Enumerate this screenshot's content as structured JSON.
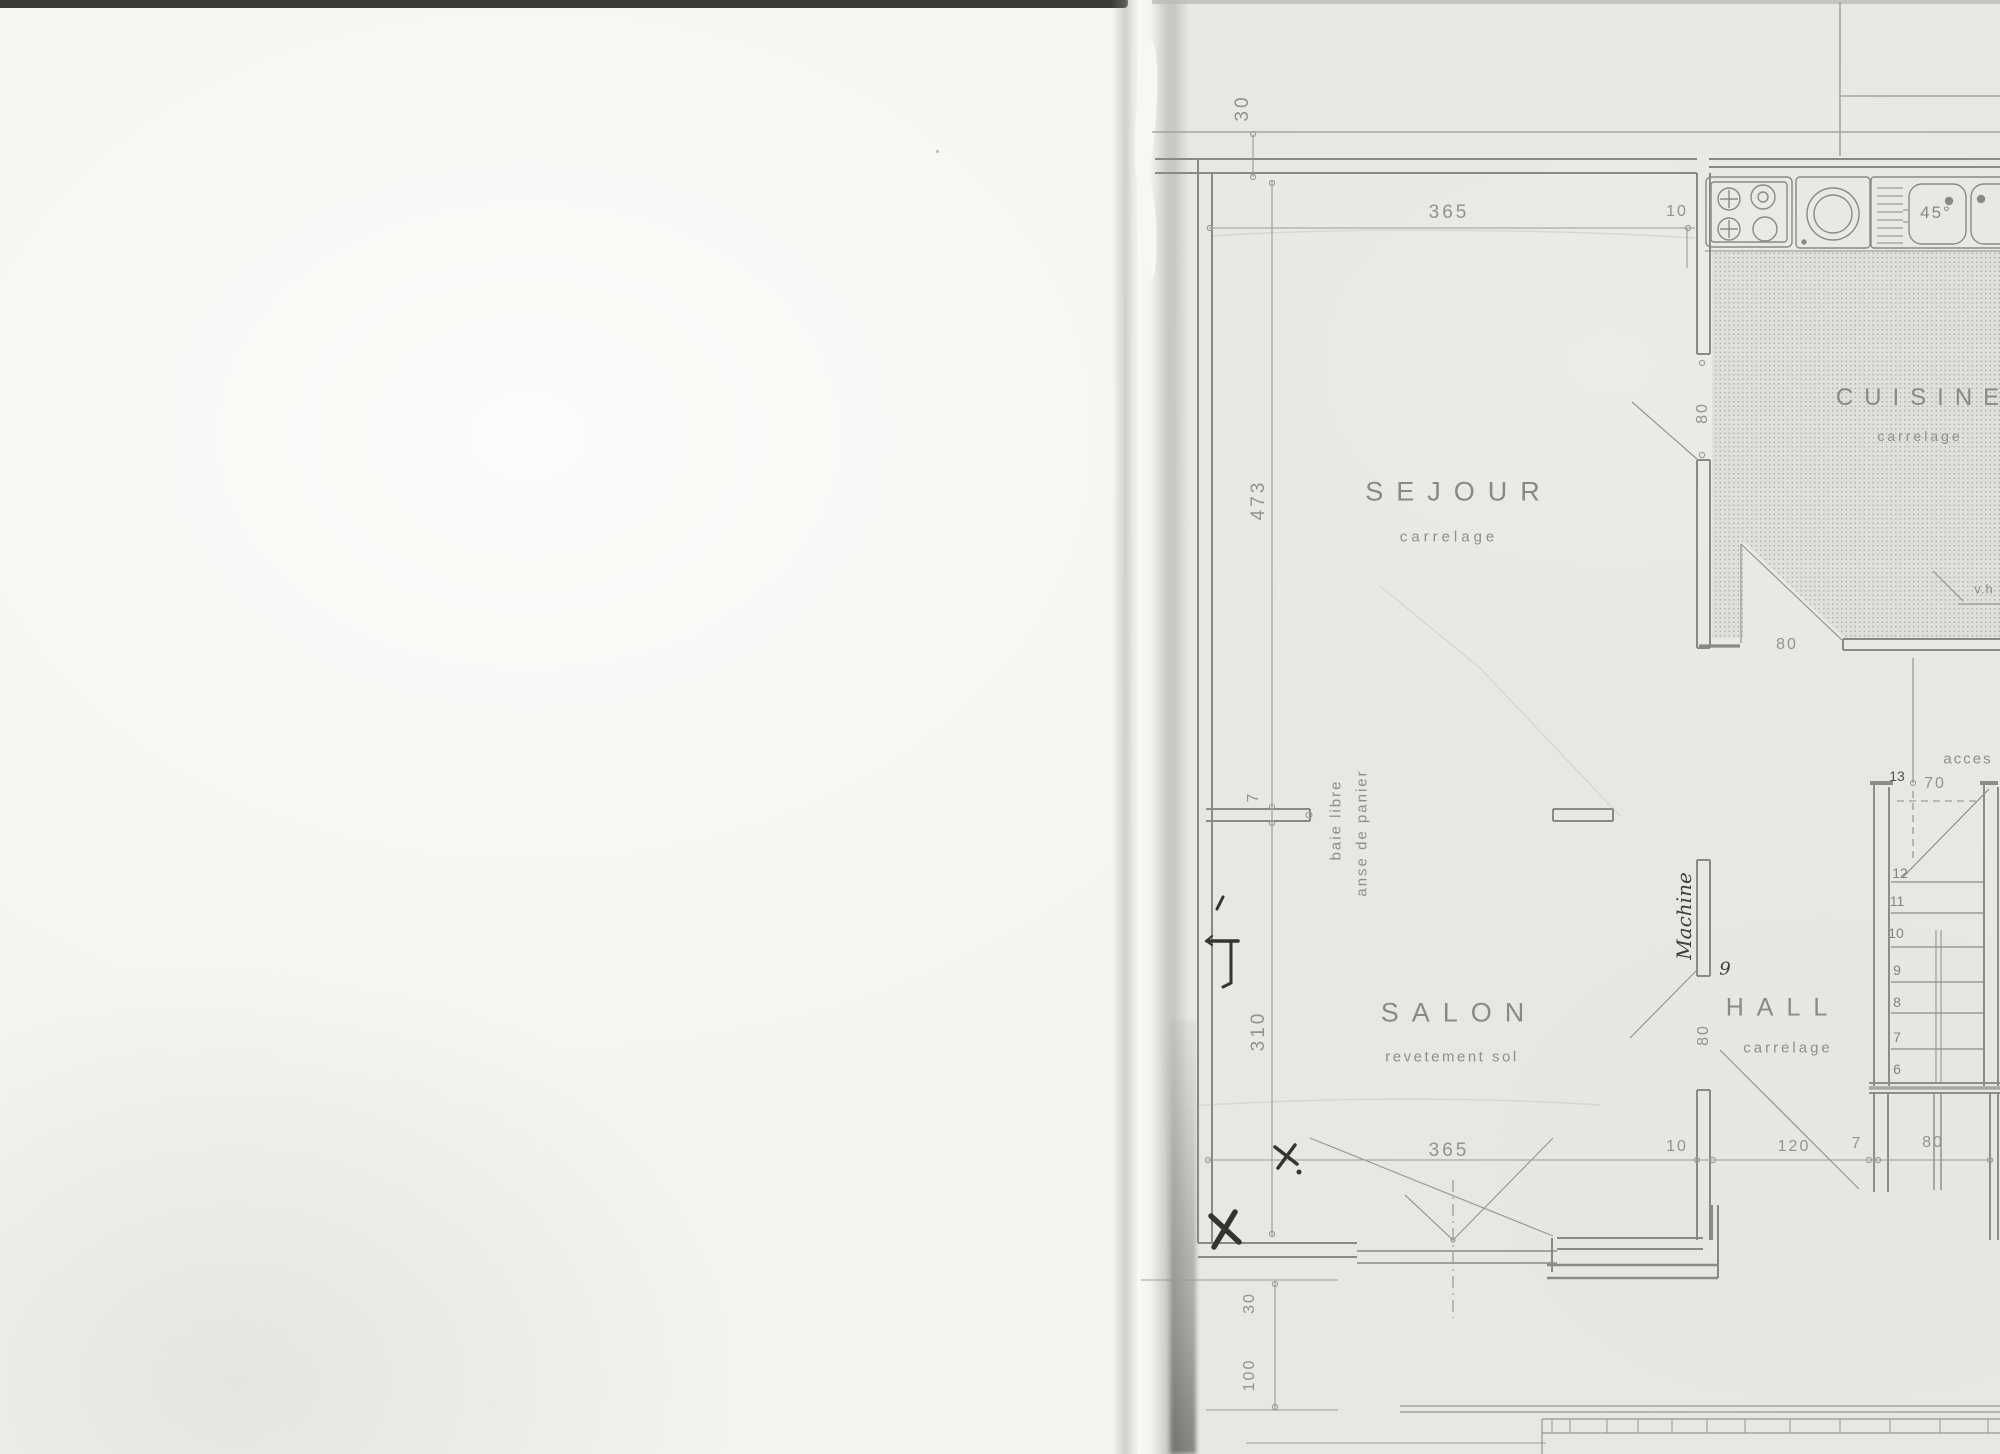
{
  "sheet": {
    "rooms": {
      "sejour": {
        "name": "SEJOUR",
        "finish": "carrelage"
      },
      "salon": {
        "name": "SALON",
        "finish": "revetement sol"
      },
      "hall": {
        "name": "HALL",
        "finish": "carrelage"
      },
      "cuisine": {
        "name": "CUISINE",
        "finish": "carrelage"
      }
    },
    "dims": {
      "top_30": "30",
      "top_365": "365",
      "top_10": "10",
      "left_473": "473",
      "left_7": "7",
      "left_310": "310",
      "left_bottom_30": "30",
      "left_bottom_100": "100",
      "kitchen_door_80": "80",
      "kitchen_back_80": "80",
      "hall_door_80": "80",
      "bottom_365": "365",
      "bottom_10": "10",
      "bottom_120": "120",
      "bottom_7": "7",
      "bottom_80": "80",
      "stairs_70": "70",
      "sink_45": "45°"
    },
    "notes": {
      "bay1": "baie libre",
      "bay2": "anse de panier",
      "access": "acces",
      "vh": "v.h"
    },
    "stairs": {
      "s6": "6",
      "s7": "7",
      "s8": "8",
      "s9": "9",
      "s10": "10",
      "s11": "11",
      "s12": "12",
      "s13": "13"
    },
    "pen": {
      "machine": "Machine",
      "nine": "9"
    }
  }
}
